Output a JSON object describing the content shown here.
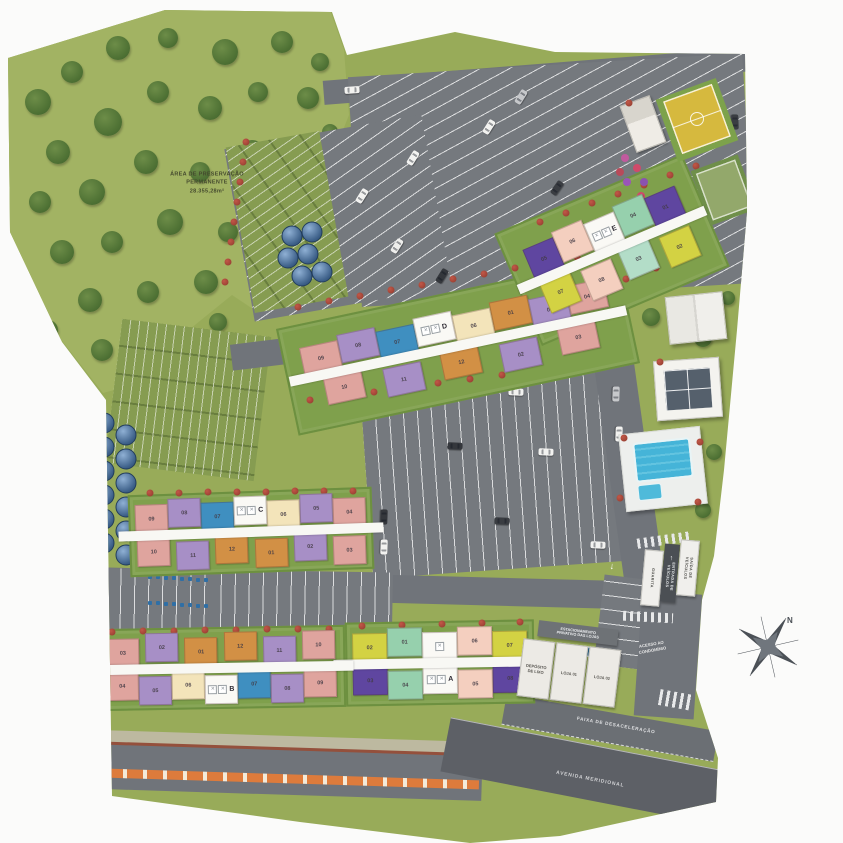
{
  "palette": {
    "pink": "#dfa49e",
    "lavender": "#a78fc6",
    "blue": "#3f8fc0",
    "cream": "#f3e4ba",
    "orange": "#d29045",
    "peach": "#f4cfbf",
    "yellow": "#d3d243",
    "mint": "#96d0ad",
    "mint_light": "#b3ddc8",
    "violet": "#5f46a0",
    "grass": "#98ab59",
    "road": "#70747a",
    "pool": "#3fb0d4"
  },
  "labels": {
    "preserve": "ÁREA DE PRESERVAÇÃO\nPERMANENTE\n28.355,28m²",
    "deceleration_lane": "FAIXA DE DESACELERAÇÃO",
    "avenue": "AVENIDA MERIDIONAL",
    "condo_access": "ACESSO AO\nCONDOMÍNIO",
    "compass_north": "N"
  },
  "gate": {
    "guardhouse": "GUARITA",
    "vehicle_entrance": "ENTRADA DE\nVEÍCULOS",
    "vehicle_exit": "SAÍDA DE\nVEÍCULOS"
  },
  "shops": {
    "sign": "ESTACIONAMENTO\nPRIVATIVO DAS LOJAS",
    "units": [
      "DEPÓSITO\nDE LIXO",
      "LOJA 01",
      "LOJA 02"
    ]
  },
  "buildings": [
    {
      "id": "A",
      "letter": "A",
      "top": [
        {
          "n": "02",
          "c": "yellow"
        },
        {
          "n": "01",
          "c": "mint"
        },
        {
          "t": "stair"
        },
        {
          "n": "06",
          "c": "peach"
        },
        {
          "n": "07",
          "c": "yellow"
        }
      ],
      "bottom": [
        {
          "n": "03",
          "c": "violet"
        },
        {
          "n": "04",
          "c": "mint"
        },
        {
          "t": "core"
        },
        {
          "n": "05",
          "c": "peach"
        },
        {
          "n": "08",
          "c": "violet"
        }
      ]
    },
    {
      "id": "B",
      "letter": "B",
      "top": [
        {
          "n": "03",
          "c": "pink"
        },
        {
          "n": "02",
          "c": "lavender"
        },
        {
          "n": "01",
          "c": "orange"
        },
        {
          "n": "12",
          "c": "orange"
        },
        {
          "n": "11",
          "c": "lavender"
        },
        {
          "n": "10",
          "c": "pink"
        }
      ],
      "bottom": [
        {
          "n": "04",
          "c": "pink"
        },
        {
          "n": "05",
          "c": "lavender"
        },
        {
          "n": "06",
          "c": "cream"
        },
        {
          "t": "core"
        },
        {
          "n": "07",
          "c": "blue"
        },
        {
          "n": "08",
          "c": "lavender"
        },
        {
          "n": "09",
          "c": "pink"
        }
      ]
    },
    {
      "id": "C",
      "letter": "C",
      "top": [
        {
          "n": "09",
          "c": "pink"
        },
        {
          "n": "08",
          "c": "lavender"
        },
        {
          "n": "07",
          "c": "blue"
        },
        {
          "t": "core"
        },
        {
          "n": "06",
          "c": "cream"
        },
        {
          "n": "05",
          "c": "lavender"
        },
        {
          "n": "04",
          "c": "pink"
        }
      ],
      "bottom": [
        {
          "n": "10",
          "c": "pink"
        },
        {
          "n": "11",
          "c": "lavender"
        },
        {
          "n": "12",
          "c": "orange"
        },
        {
          "n": "01",
          "c": "orange"
        },
        {
          "n": "02",
          "c": "lavender"
        },
        {
          "n": "03",
          "c": "pink"
        }
      ]
    },
    {
      "id": "D",
      "letter": "D",
      "top": [
        {
          "n": "09",
          "c": "pink"
        },
        {
          "n": "08",
          "c": "lavender"
        },
        {
          "n": "07",
          "c": "blue"
        },
        {
          "t": "core"
        },
        {
          "n": "06",
          "c": "cream"
        },
        {
          "n": "01",
          "c": "orange"
        },
        {
          "n": "05",
          "c": "lavender"
        },
        {
          "n": "04",
          "c": "pink"
        }
      ],
      "bottom": [
        {
          "n": "10",
          "c": "pink"
        },
        {
          "n": "11",
          "c": "lavender"
        },
        {
          "n": "12",
          "c": "orange"
        },
        {
          "n": "02",
          "c": "lavender"
        },
        {
          "n": "03",
          "c": "pink"
        }
      ]
    },
    {
      "id": "E",
      "letter": "E",
      "top": [
        {
          "n": "05",
          "c": "violet"
        },
        {
          "n": "06",
          "c": "peach"
        },
        {
          "t": "core"
        },
        {
          "n": "04",
          "c": "mint"
        },
        {
          "n": "01",
          "c": "violet"
        }
      ],
      "bottom": [
        {
          "n": "07",
          "c": "yellow"
        },
        {
          "n": "08",
          "c": "peach"
        },
        {
          "n": "03",
          "c": "mint_light"
        },
        {
          "n": "02",
          "c": "yellow"
        }
      ]
    }
  ]
}
